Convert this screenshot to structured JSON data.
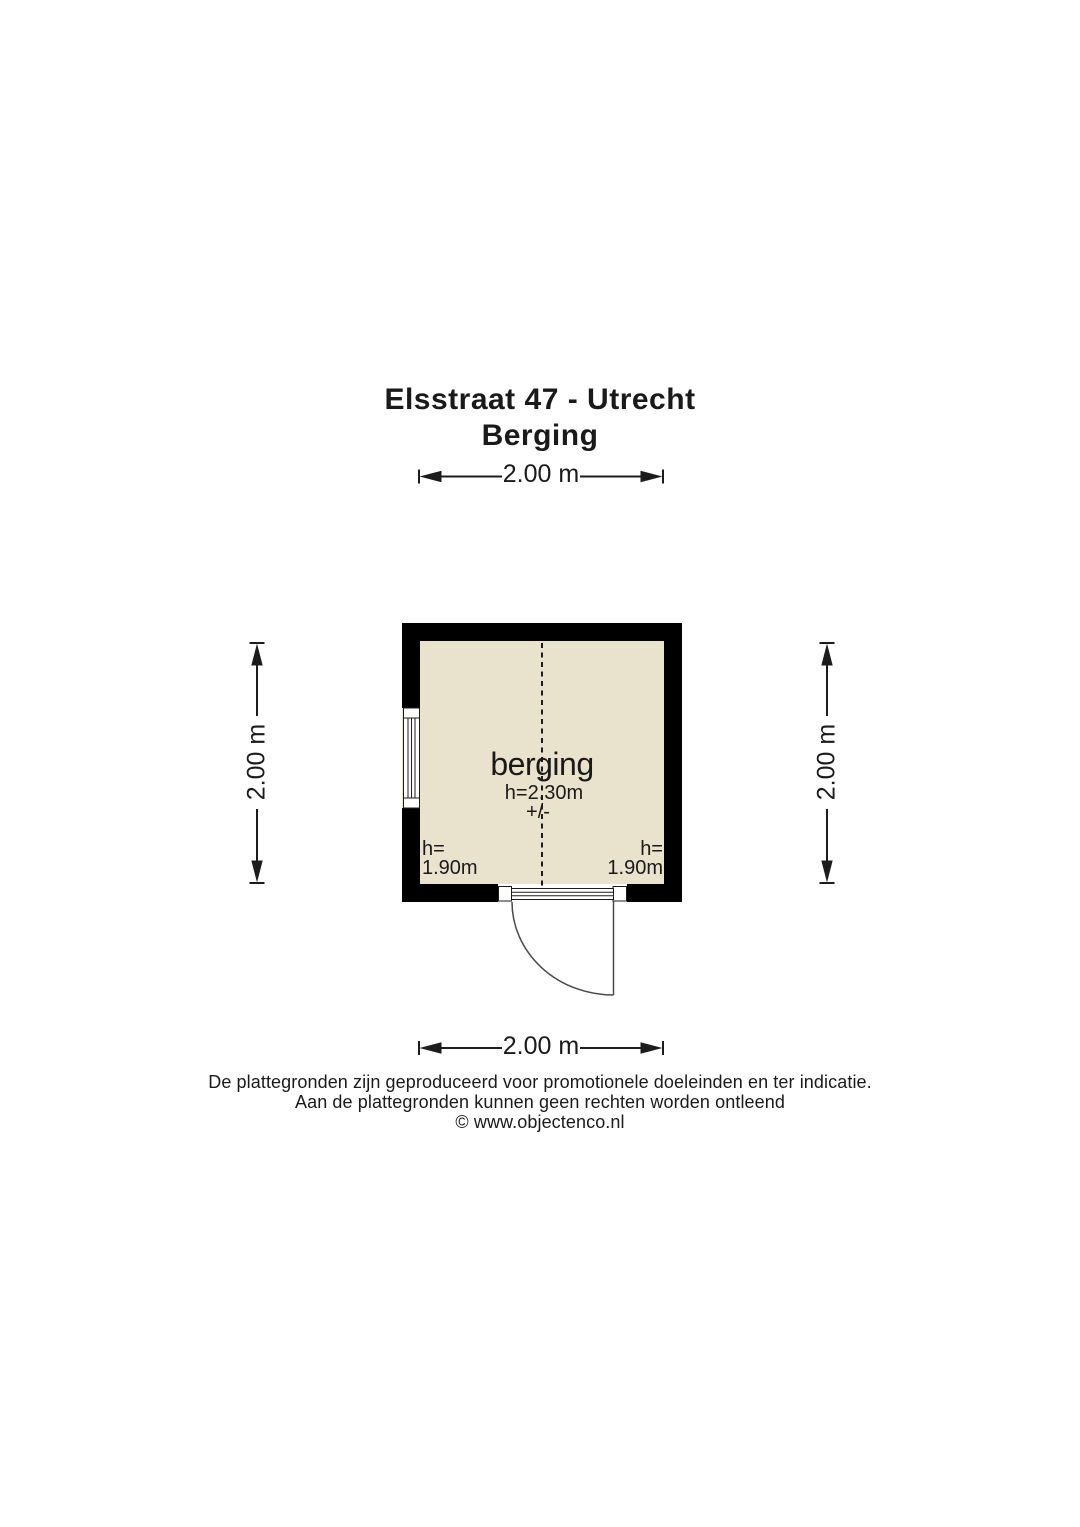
{
  "title": {
    "line1": "Elsstraat 47 - Utrecht",
    "line2": "Berging"
  },
  "dimensions": {
    "top_label": "2.00 m",
    "bottom_label": "2.00 m",
    "left_label": "2.00 m",
    "right_label": "2.00 m"
  },
  "room": {
    "name": "berging",
    "ceiling_height_label": "h=2.30m",
    "tolerance_label": "+/-",
    "left_wall_height": {
      "line1": "h=",
      "line2": "1.90m"
    },
    "right_wall_height": {
      "line1": "h=",
      "line2": "1.90m"
    }
  },
  "footer": {
    "line1": "De plattegronden zijn geproduceerd voor promotionele doeleinden en ter indicatie.",
    "line2": "Aan de plattegronden kunnen geen rechten worden ontleend",
    "line3": "© www.objectenco.nl"
  },
  "colors": {
    "wall": "#000000",
    "floor": "#e9e2cc",
    "line": "#1c1c1c",
    "door_line": "#4a4a4a",
    "background": "#ffffff"
  }
}
